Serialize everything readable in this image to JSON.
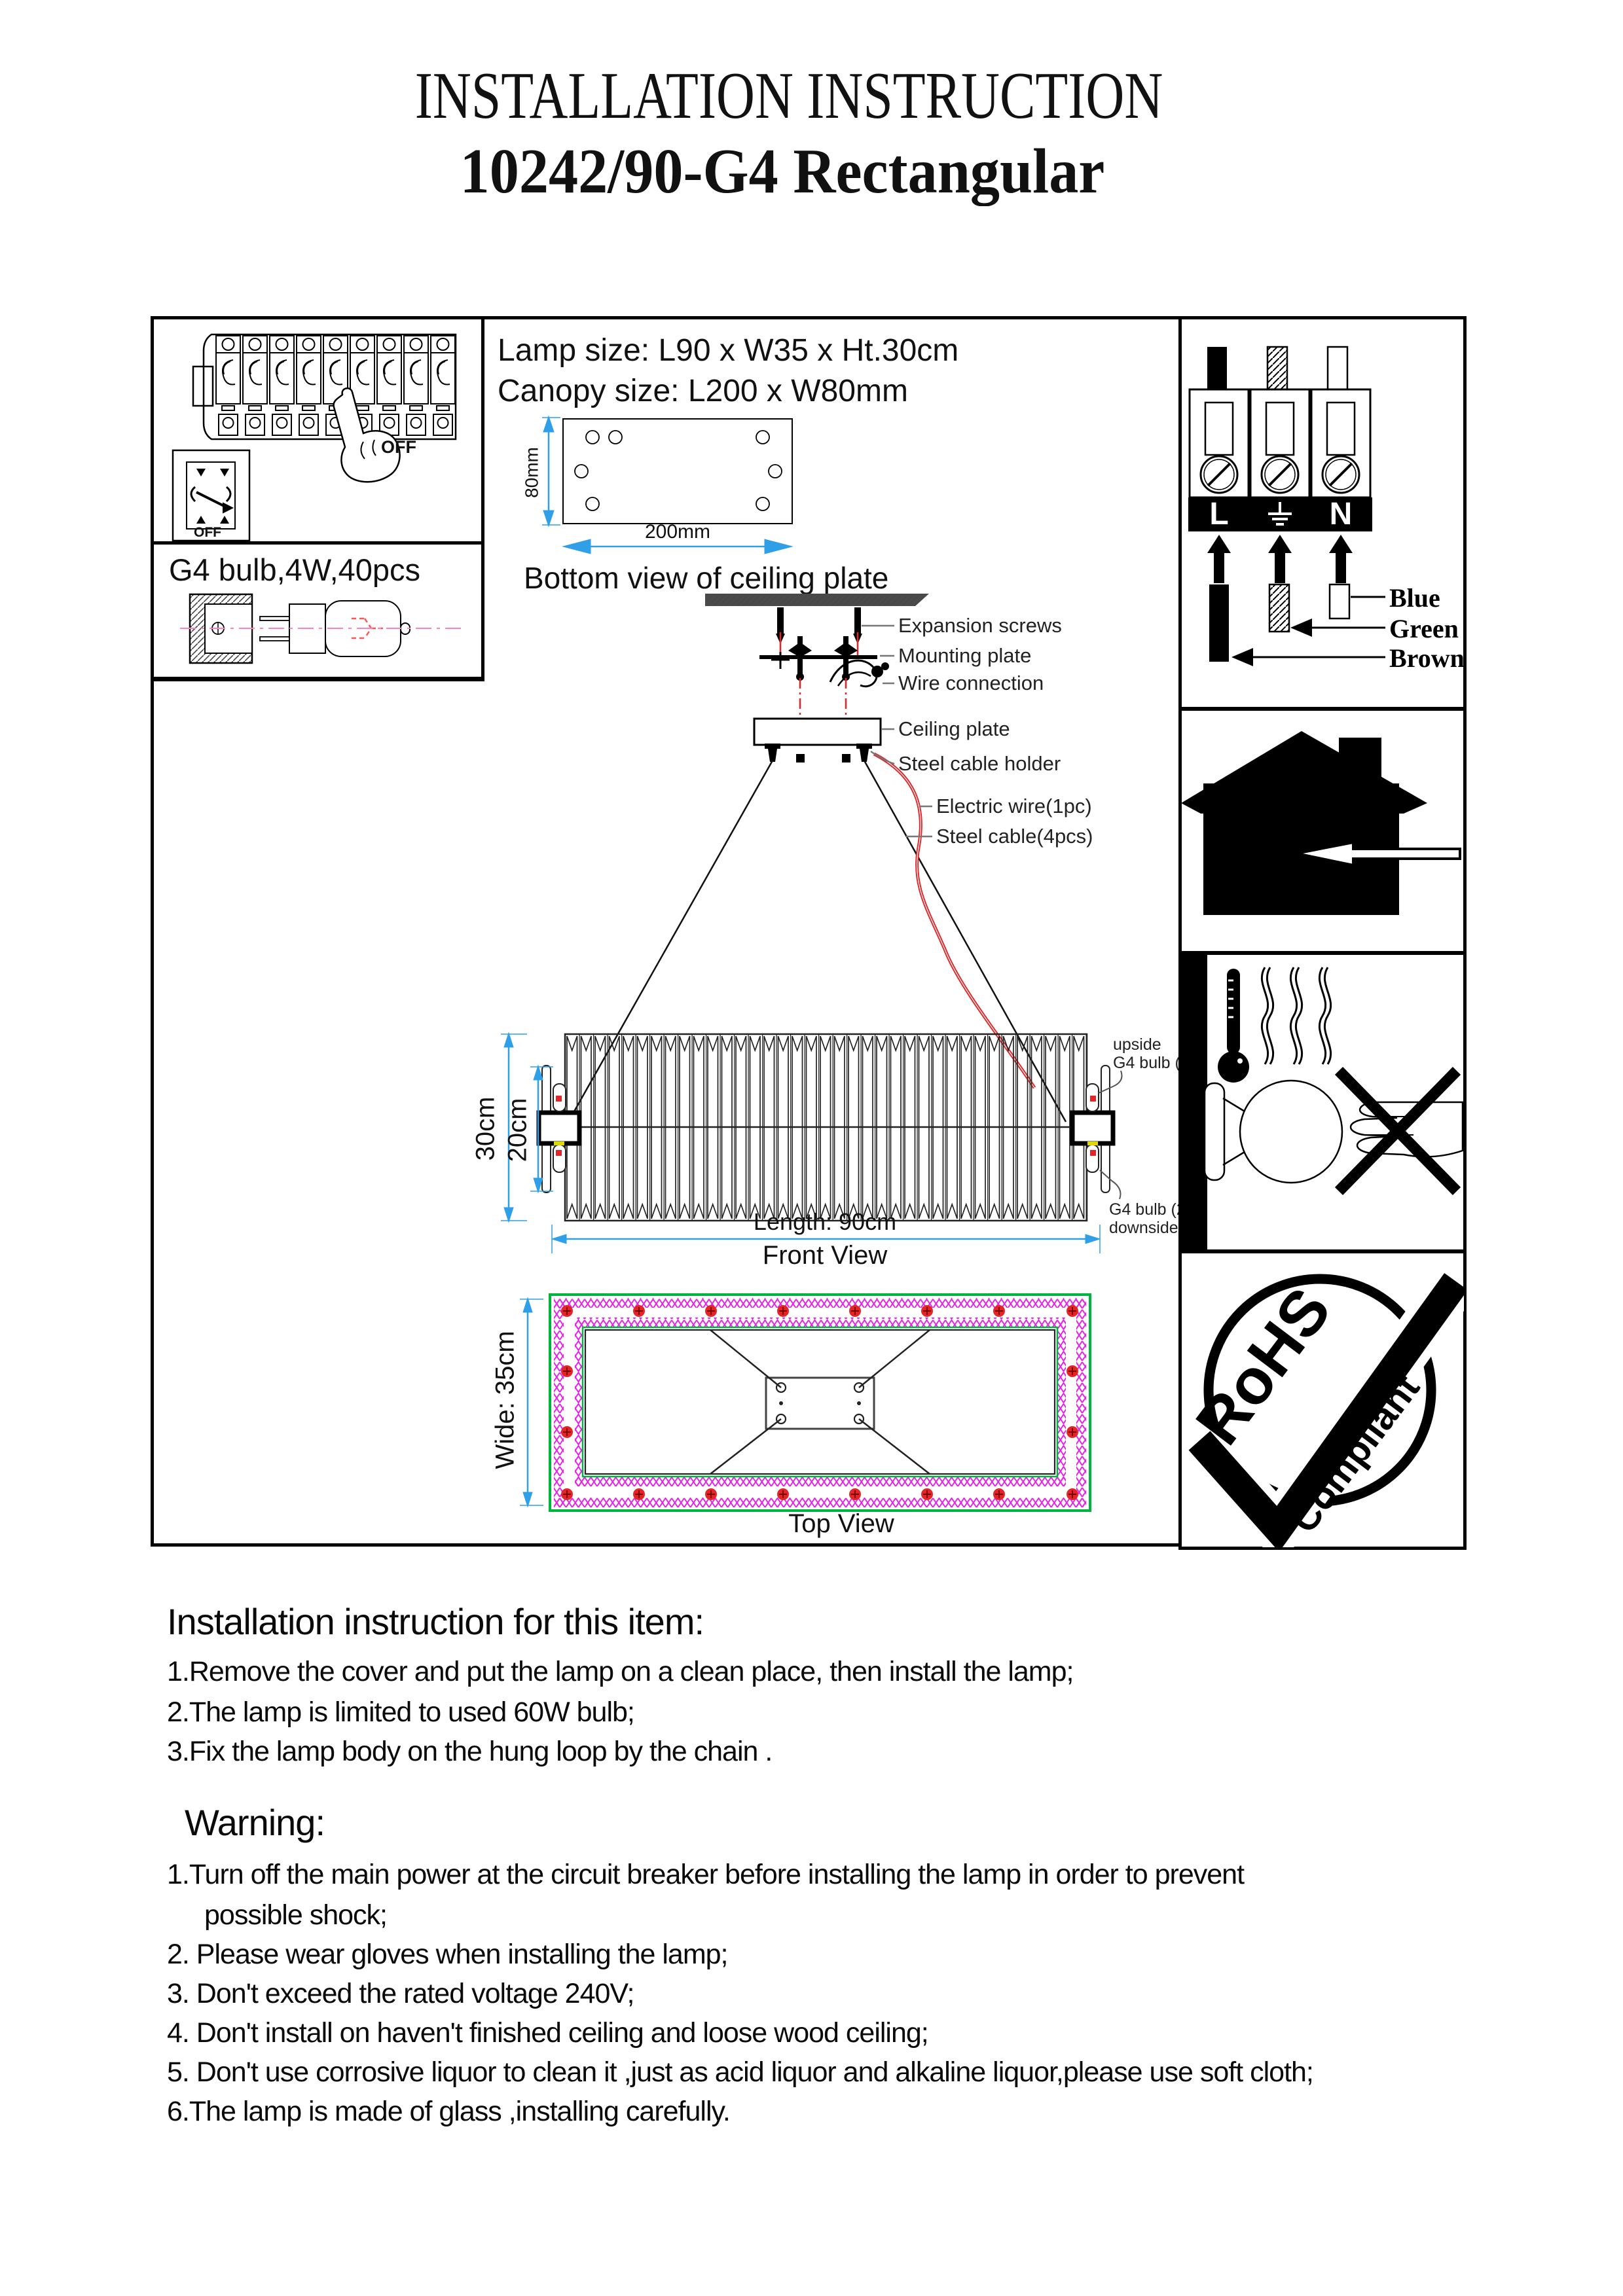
{
  "doc": {
    "title": "INSTALLATION INSTRUCTION",
    "model": "10242/90-G4 Rectangular"
  },
  "left_panel": {
    "breaker_off": "OFF",
    "switch_off": "OFF",
    "bulb_spec": "G4 bulb,4W,40pcs"
  },
  "specs": {
    "lamp_size": "Lamp size: L90 x W35 x Ht.30cm",
    "canopy_size": "Canopy size: L200 x W80mm",
    "plate_height": "80mm",
    "plate_length": "200mm",
    "plate_caption": "Bottom view of ceiling plate"
  },
  "suspension": {
    "expansion": "Expansion screws",
    "mounting": "Mounting plate",
    "wire": "Wire connection",
    "ceiling_plate": "Ceiling plate",
    "cable_holder": "Steel cable holder",
    "electric_wire": "Electric wire(1pc)",
    "steel_cable": "Steel cable(4pcs)"
  },
  "front_view": {
    "height": "30cm",
    "inner_height": "20cm",
    "length": "Length: 90cm",
    "caption": "Front View",
    "upside_1": "upside",
    "upside_2": "G4 bulb (20pcs)",
    "downside_1": "G4 bulb (20pcs)",
    "downside_2": "downside"
  },
  "top_view": {
    "width": "Wide: 35cm",
    "caption": "Top View"
  },
  "wiring": {
    "live": "L",
    "neutral": "N",
    "blue": "Blue",
    "green": "Green",
    "brown": "Brown"
  },
  "rohs": {
    "word1": "RoHS",
    "word2": "Compliant"
  },
  "instructions": {
    "heading": "Installation instruction for this item:",
    "item1": "1.Remove the cover and put the lamp on a clean place, then install the lamp;",
    "item2": "2.The lamp is limited to used  60W bulb;",
    "item3": "3.Fix the lamp body on the  hung loop by the chain ."
  },
  "warnings": {
    "heading": "Warning:",
    "line1": "1.Turn off the main power at the circuit breaker before installing the lamp in order to prevent",
    "line1b": "possible shock;",
    "line2": "2. Please wear gloves when installing the lamp;",
    "line3": "3. Don't exceed the rated voltage 240V;",
    "line4": "4. Don't install on haven't finished ceiling and loose wood ceiling;",
    "line5": "5. Don't use corrosive liquor to clean it ,just as acid liquor and alkaline liquor,please use soft cloth;",
    "line6": "6.The lamp is made of  glass ,installing carefully."
  },
  "colors": {
    "dimension_blue": "#2f9fe8",
    "wire_red": "#e32528",
    "crystal_magenta": "#e822e8",
    "frame_green": "#00b43e",
    "axis_pink": "#ff7fbf",
    "ink_black": "#000000"
  }
}
